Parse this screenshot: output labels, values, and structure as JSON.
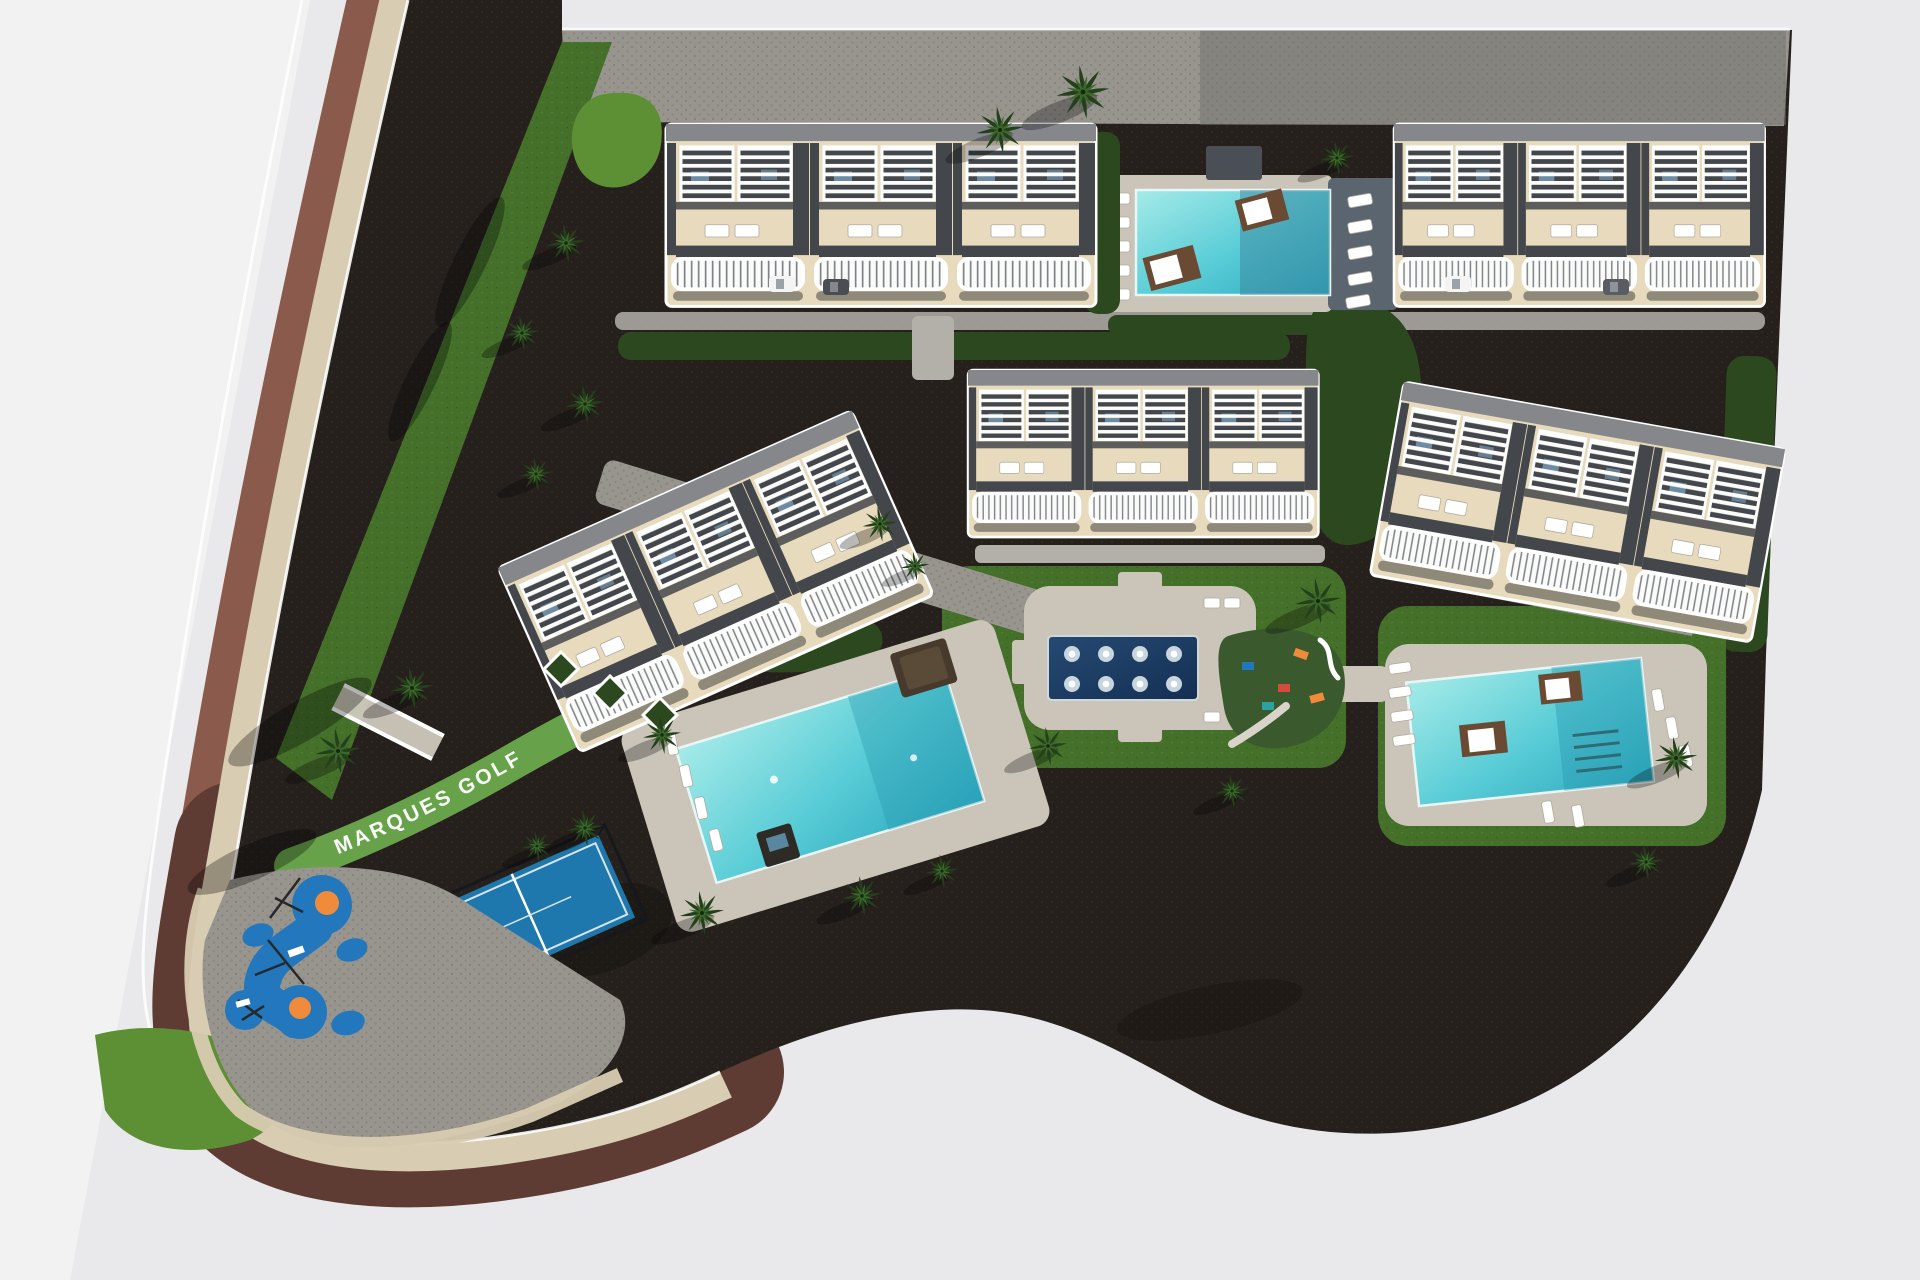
{
  "site": {
    "label": "MARQUES GOLF"
  },
  "counts": {
    "residential_blocks": 5,
    "swimming_pools": 3,
    "spa_pools": 1,
    "padel_courts": 1,
    "playgrounds": 2,
    "tennis_daybeds": 4
  },
  "palette": {
    "bg": "#e9e9eb",
    "bg_left": "#f2f2f3",
    "asphalt": "#26201c",
    "road_brown": "#8a5a4c",
    "road_brown_dark": "#5f3c33",
    "curb_cream": "#d8ccb2",
    "paver": "#98958f",
    "paver_light": "#b3b0aa",
    "deck": "#cbc5b9",
    "deck_dark": "#5b6570",
    "grass": "#44702a",
    "grass_light": "#5d8f35",
    "hedge": "#2c481e",
    "hedge_bright": "#67a24b",
    "building_cream": "#e8dabc",
    "building_dark": "#43474b",
    "roof_gray": "#85878b",
    "pool_cyan": "#58ccd6",
    "pool_deep": "#2fa9c0",
    "spa_navy": "#1d3c63",
    "tennis_blue": "#1e78ad",
    "play_blue": "#2277bd",
    "play_orange": "#ef8b3a",
    "rubber_green": "#3a5a2e",
    "white": "#ffffff"
  }
}
